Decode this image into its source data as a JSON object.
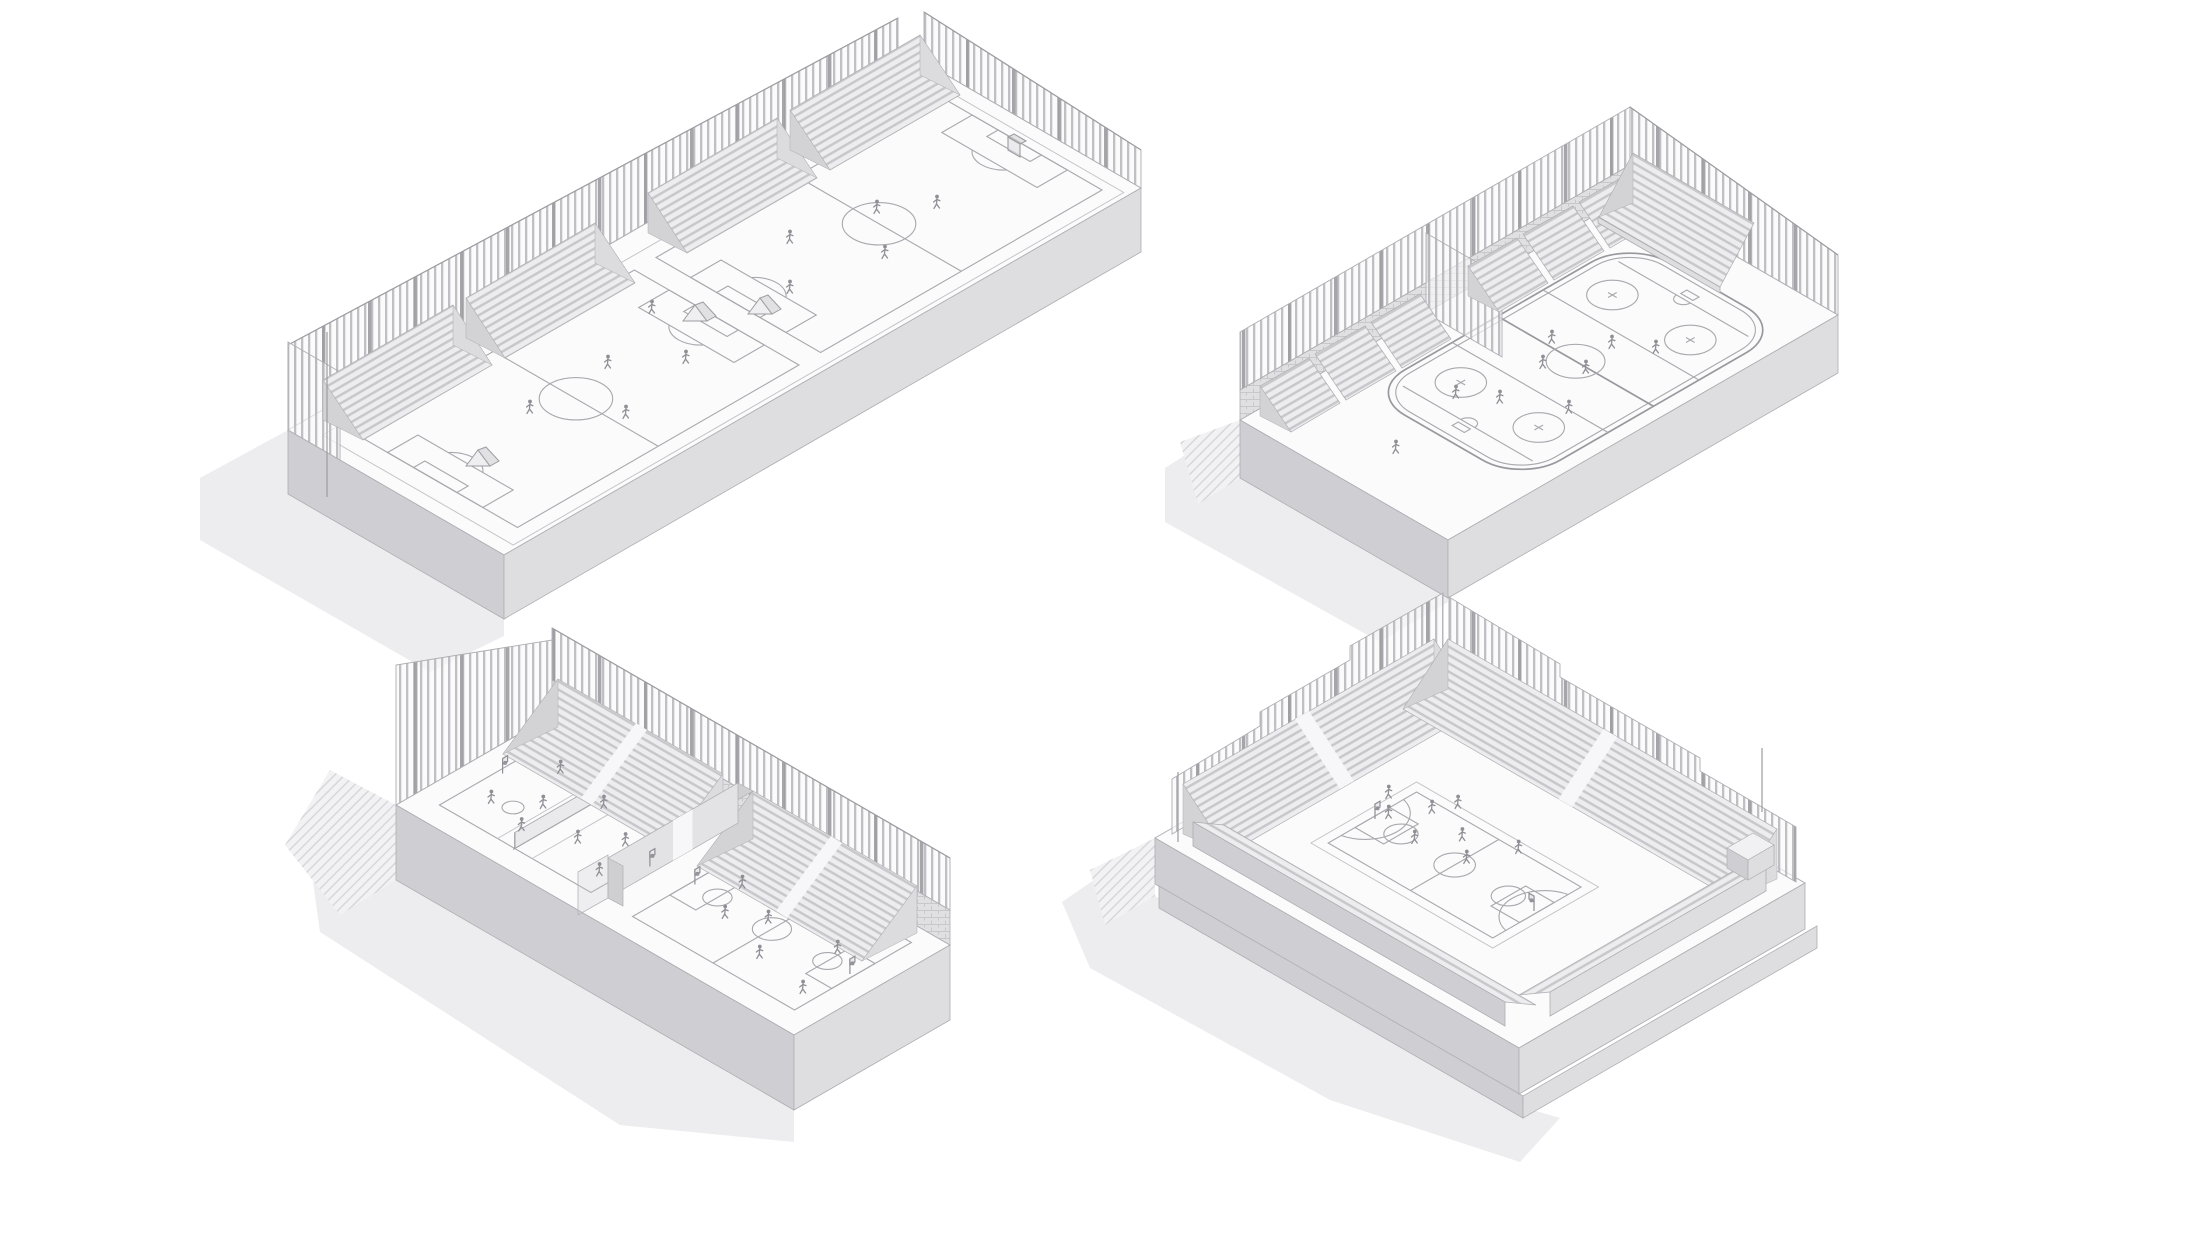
{
  "sheet": {
    "background": "#ffffff",
    "kind": "architectural-axonometric-sheet",
    "visible_text": ""
  },
  "palette": {
    "bg": "#ffffff",
    "edge": "#aeaeb3",
    "line": "#a8a8ad",
    "line-soft": "#c5c5c9",
    "face-top": "#fbfbfc",
    "face-a": "#cfcfd3",
    "face-b": "#dedee1",
    "shadow": "#e8e8eb",
    "bleach": "#ededef",
    "row": "#c8c8cc",
    "slat": "#b5b5ba",
    "post": "#9c9ca1",
    "fig": "#8f8f96",
    "brick": "#e0e0e3",
    "brickline": "#c8c8cc",
    "hatchline": "#d6d6da"
  },
  "panels": [
    {
      "id": "soccer-fields",
      "position": "top-left",
      "label": "Axonometric drawing: fenced podium with two soccer pitches, grandstand rows and tall perimeter fence"
    },
    {
      "id": "ice-rink",
      "position": "top-right",
      "label": "Axonometric drawing: outdoor ice hockey rink with faceoff circles, side bleachers, end grandstand and fence"
    },
    {
      "id": "dual-courts",
      "position": "bottom-left",
      "label": "Axonometric drawing: walled facility with volleyball and basketball courts, central divider and bleacher banks"
    },
    {
      "id": "basketball-arena",
      "position": "bottom-right",
      "label": "Axonometric drawing: sunken basketball arena surrounded by bleachers and perimeter fence"
    }
  ]
}
